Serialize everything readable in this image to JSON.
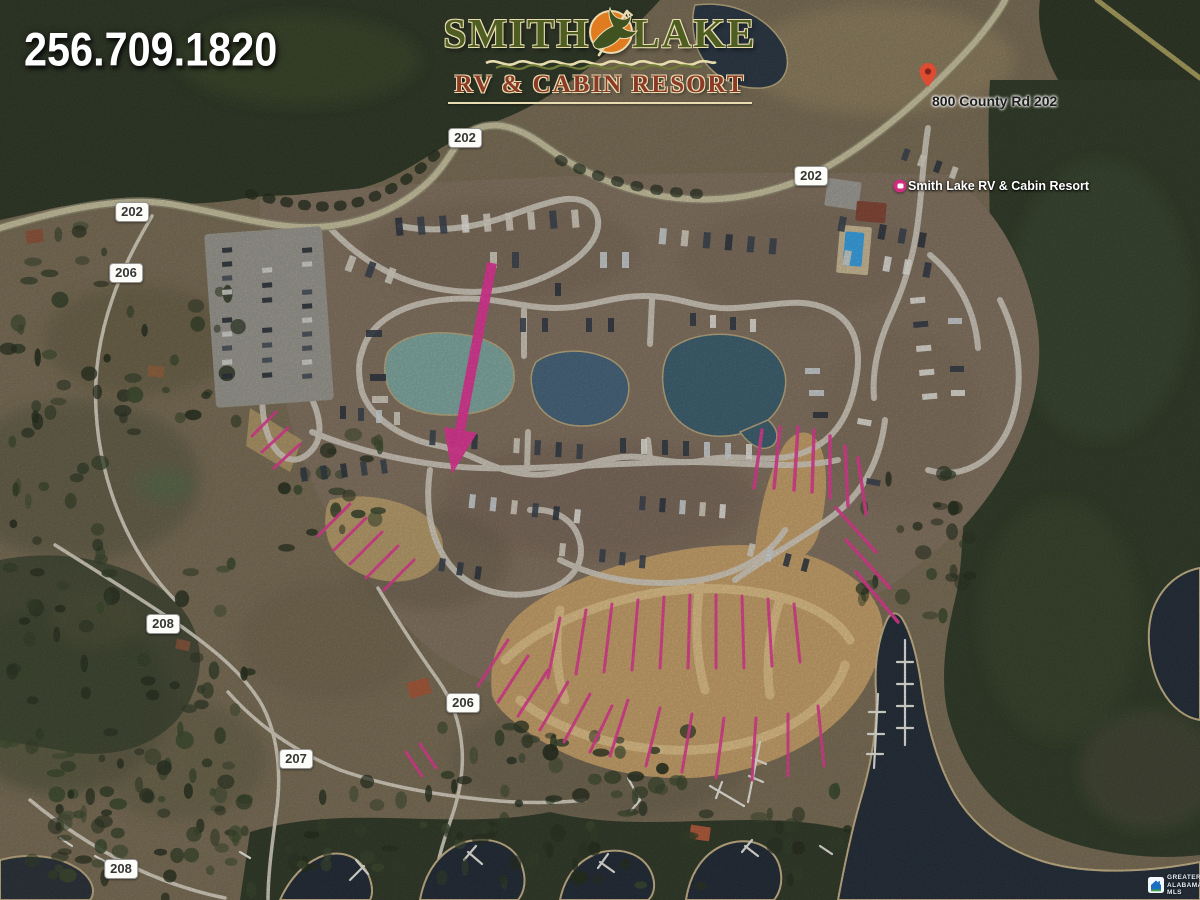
{
  "phone": "256.709.1820",
  "logo": {
    "word1": "SMITH",
    "word2": "LAKE",
    "subtitle": "RV & CABIN RESORT"
  },
  "map_labels": {
    "address_pin": "800 County Rd 202",
    "resort_pin": "Smith Lake RV & Cabin Resort"
  },
  "road_badges": [
    {
      "text": "202",
      "x": 465,
      "y": 138
    },
    {
      "text": "202",
      "x": 132,
      "y": 212
    },
    {
      "text": "206",
      "x": 126,
      "y": 273
    },
    {
      "text": "202",
      "x": 811,
      "y": 176
    },
    {
      "text": "208",
      "x": 163,
      "y": 624
    },
    {
      "text": "206",
      "x": 463,
      "y": 703
    },
    {
      "text": "207",
      "x": 296,
      "y": 759
    },
    {
      "text": "208",
      "x": 121,
      "y": 869
    }
  ],
  "mls": {
    "line1": "GREATER",
    "line2": "ALABAMA",
    "line3": "MLS"
  },
  "colors": {
    "arrow_pink": "#e52a94",
    "lot_line_pink": "#e3308f",
    "pond_teal": "#7aa69f",
    "pond_blue": "#3c5c76",
    "water_navy": "#16202e",
    "logo_green": "#4e5e23",
    "logo_rust": "#8c3a28",
    "logo_orange": "#e07b1f",
    "pool_blue": "#2d9fe8"
  }
}
